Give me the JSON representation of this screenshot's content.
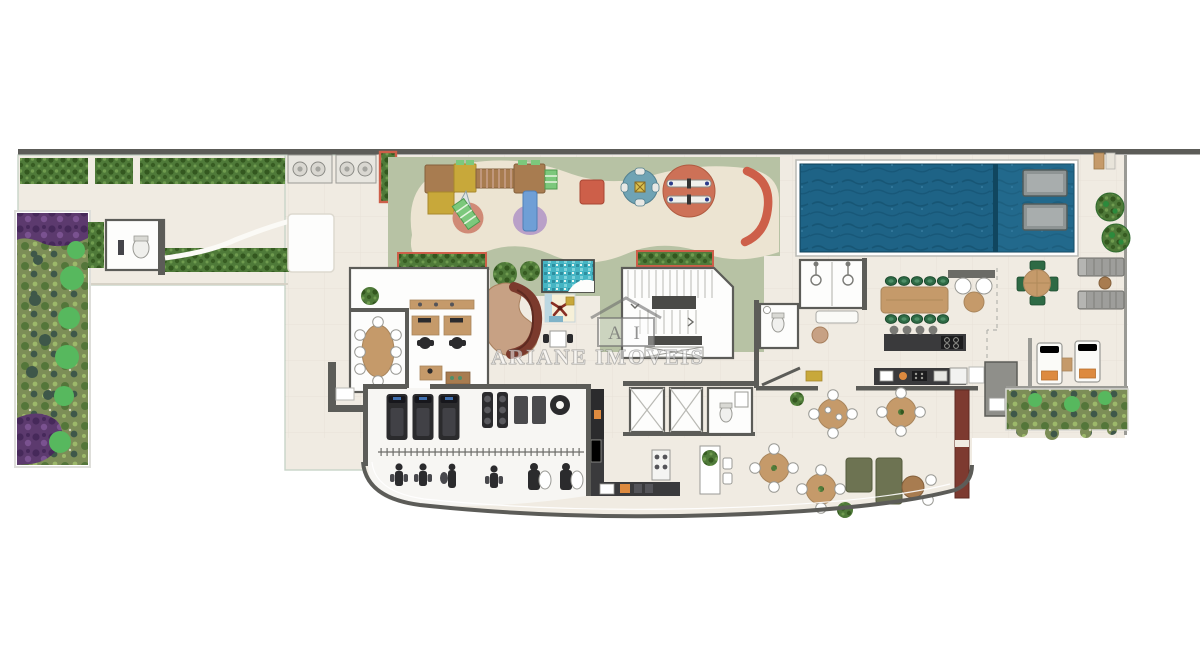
{
  "watermark": {
    "logo_initials": "A I",
    "brand": "ARIANE IMOVEIS"
  },
  "colors": {
    "floor": "#f0ebe2",
    "floor_edge": "#c8d4c8",
    "room_white": "#fdfdfc",
    "wall_dark": "#5c5c58",
    "wall_mid": "#9a9a95",
    "grass": "#b7c2a4",
    "path_cream": "#ece4d2",
    "hedge_green": "#4f7a39",
    "hedge_dark": "#33571f",
    "garden_green": "#7c8d57",
    "garden_dark": "#54763a",
    "garden_purple": "#5c3a6e",
    "garden_purple_dark": "#46295a",
    "palm_green": "#57b85e",
    "pool_water": "#1e6386",
    "pool_water_dark": "#14506e",
    "pool_shelf": "#2e7ba0",
    "mosaic_teal": "#45b5c4",
    "accent_red": "#cd5f49",
    "wood": "#a87c50",
    "wood_light": "#c59a6a",
    "play_yellow": "#c8a83a",
    "play_blue": "#6fa3b4",
    "play_pink": "#d08a76",
    "play_purple": "#b9a0c8",
    "slide_blue": "#6f9fd6",
    "mat_green": "#7cc87c",
    "chair_green": "#2e6a45",
    "sofa_olive": "#6d7352",
    "sofa_maroon": "#7b3a2d",
    "sofa_tan": "#c7a184",
    "counter_dark": "#3a3a3c",
    "equip_dark": "#2b2b2d",
    "lounger_gray": "#9e9e9b",
    "towel_orange": "#dd8a3f",
    "maroon_wall": "#7d3a30",
    "watermark_fill": "rgba(255,255,255,0.50)",
    "watermark_stroke": "rgba(110,110,110,0.60)"
  }
}
